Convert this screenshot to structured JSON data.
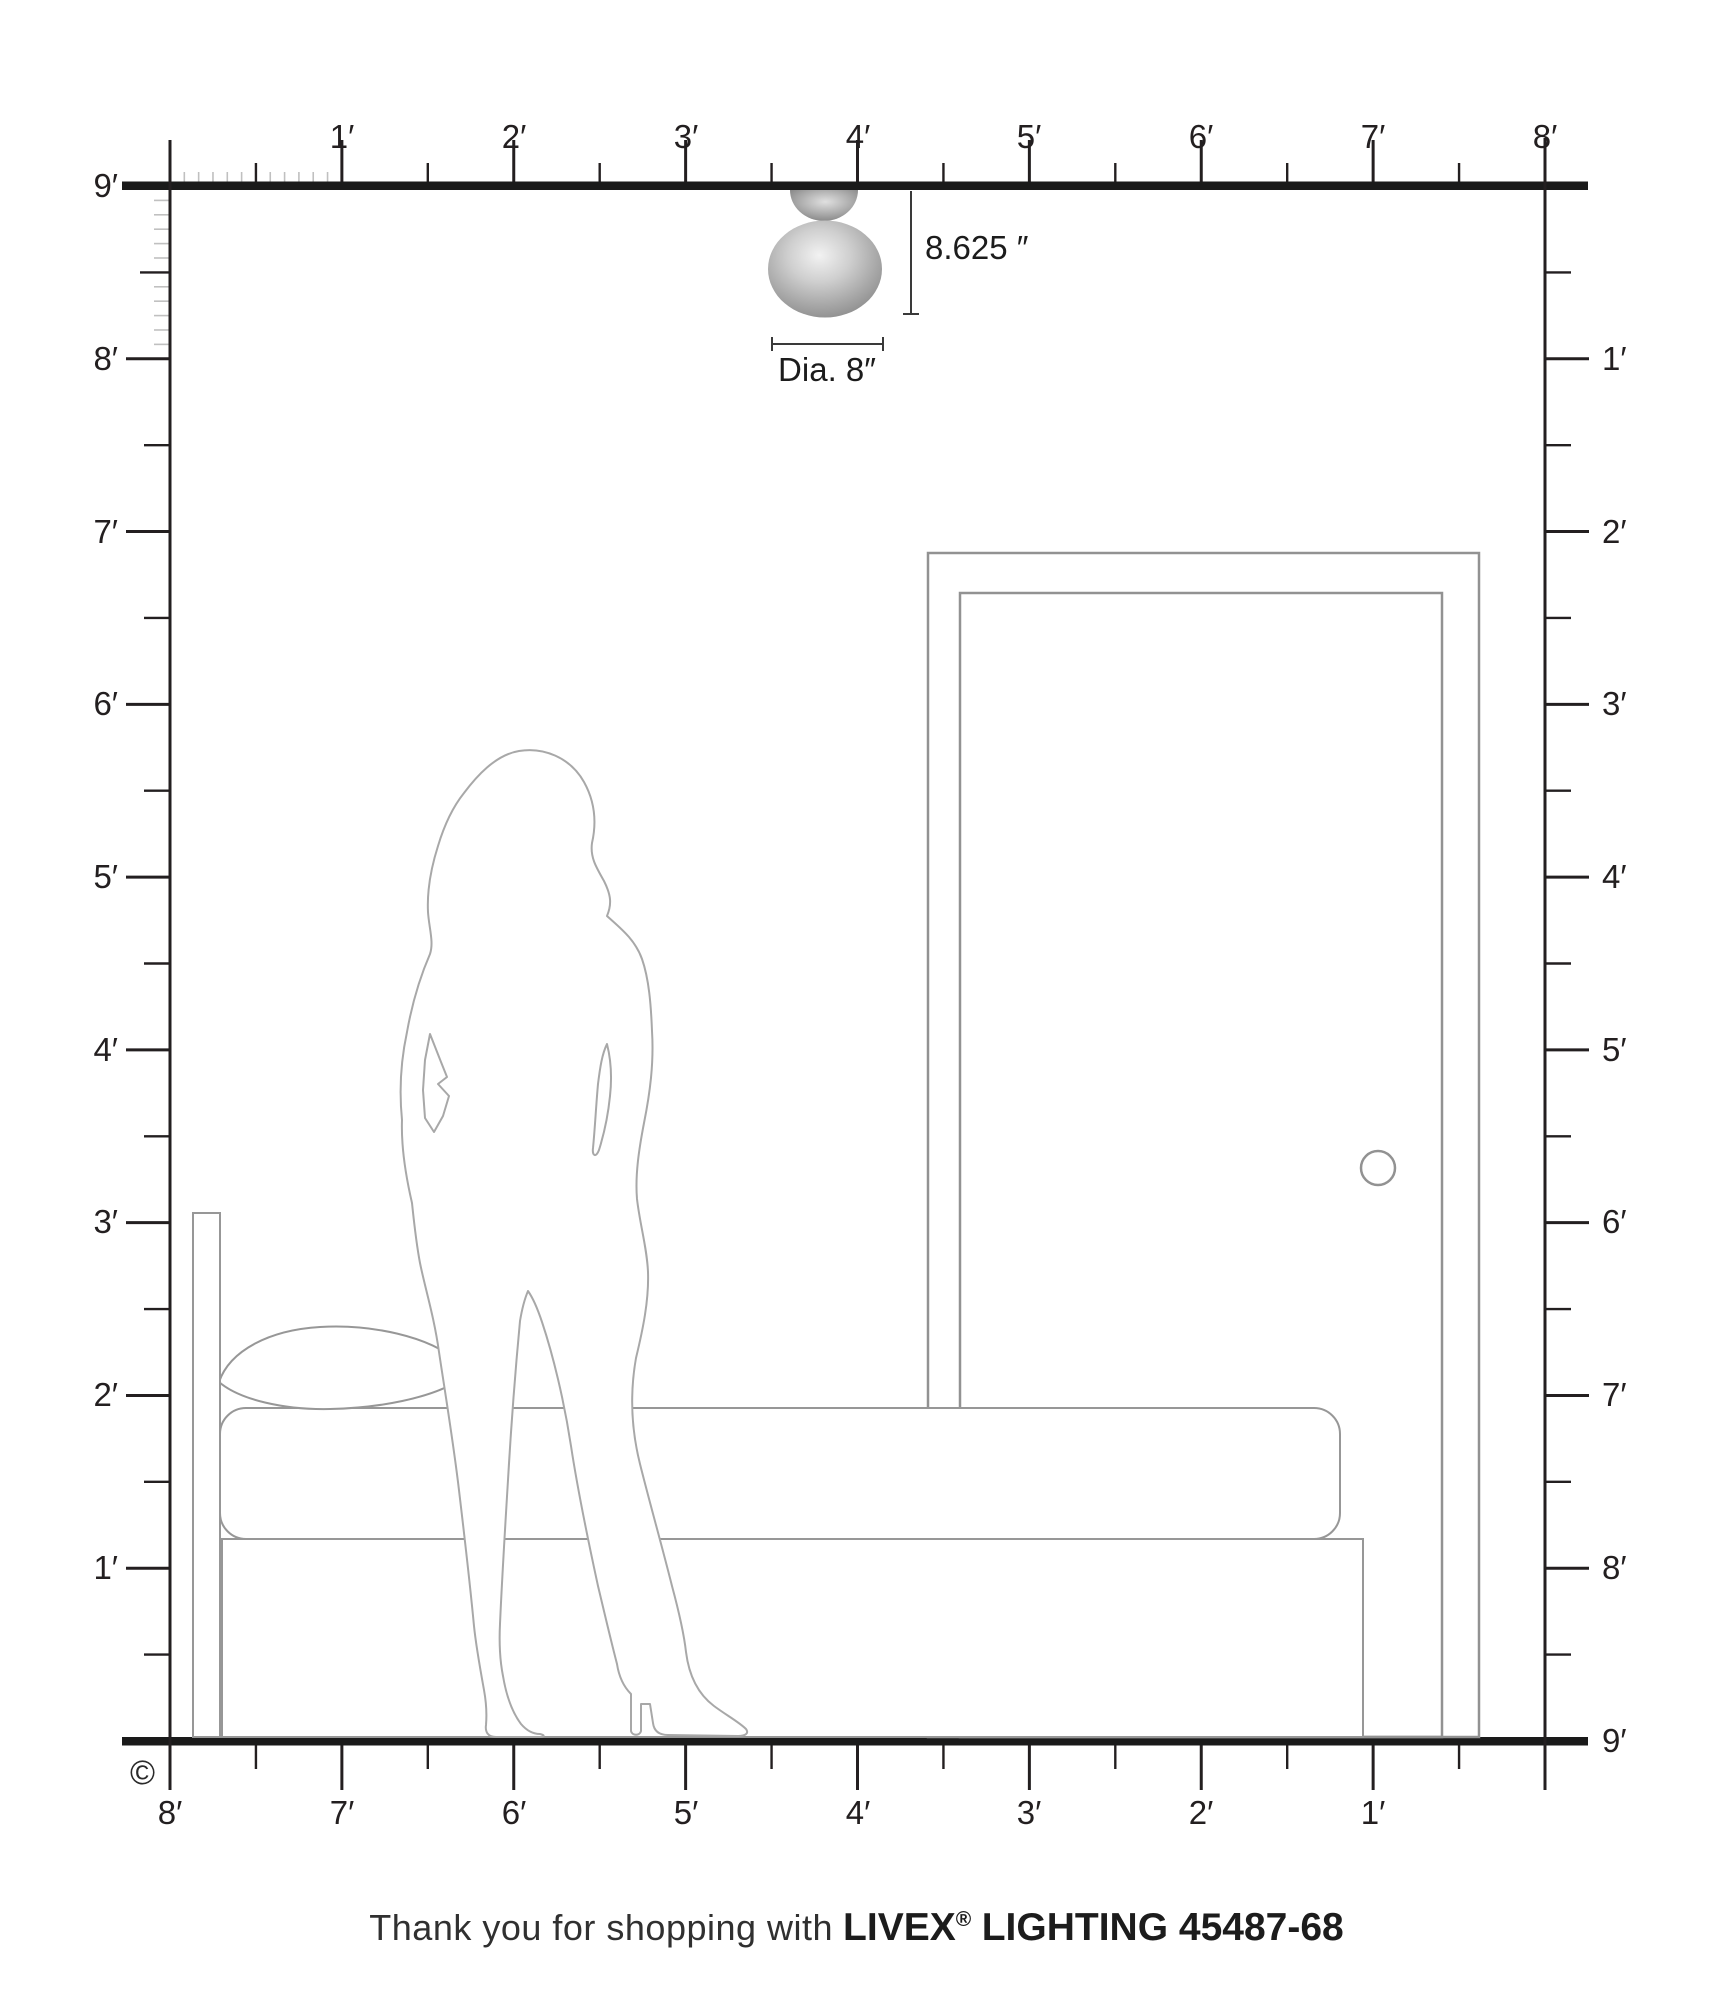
{
  "diagram": {
    "fixture": {
      "height_label": "8.625 ″",
      "diameter_label": "Dia. 8″"
    },
    "rulers": {
      "top": {
        "unit": "feet",
        "labels": [
          "1′",
          "2′",
          "3′",
          "4′",
          "5′",
          "6′",
          "7′",
          "8′"
        ]
      },
      "left": {
        "unit": "feet",
        "labels": [
          "9′",
          "8′",
          "7′",
          "6′",
          "5′",
          "4′",
          "3′",
          "2′",
          "1′"
        ]
      },
      "right": {
        "unit": "feet",
        "labels": [
          "1′",
          "2′",
          "3′",
          "4′",
          "5′",
          "6′",
          "7′",
          "8′",
          "9′"
        ]
      },
      "bottom": {
        "unit": "feet",
        "labels": [
          "8′",
          "7′",
          "6′",
          "5′",
          "4′",
          "3′",
          "2′",
          "1′"
        ]
      }
    },
    "copyright_symbol": "©",
    "colors": {
      "ruler_dark": "#231f20",
      "inch_tick": "#c0c0c0",
      "furniture_outline": "#979797",
      "silhouette_outline": "#a8a8a8"
    }
  },
  "footer": {
    "prefix": "Thank you for shopping with",
    "brand": "LIVEX",
    "registered": "®",
    "suffix": "LIGHTING 45487-68"
  }
}
